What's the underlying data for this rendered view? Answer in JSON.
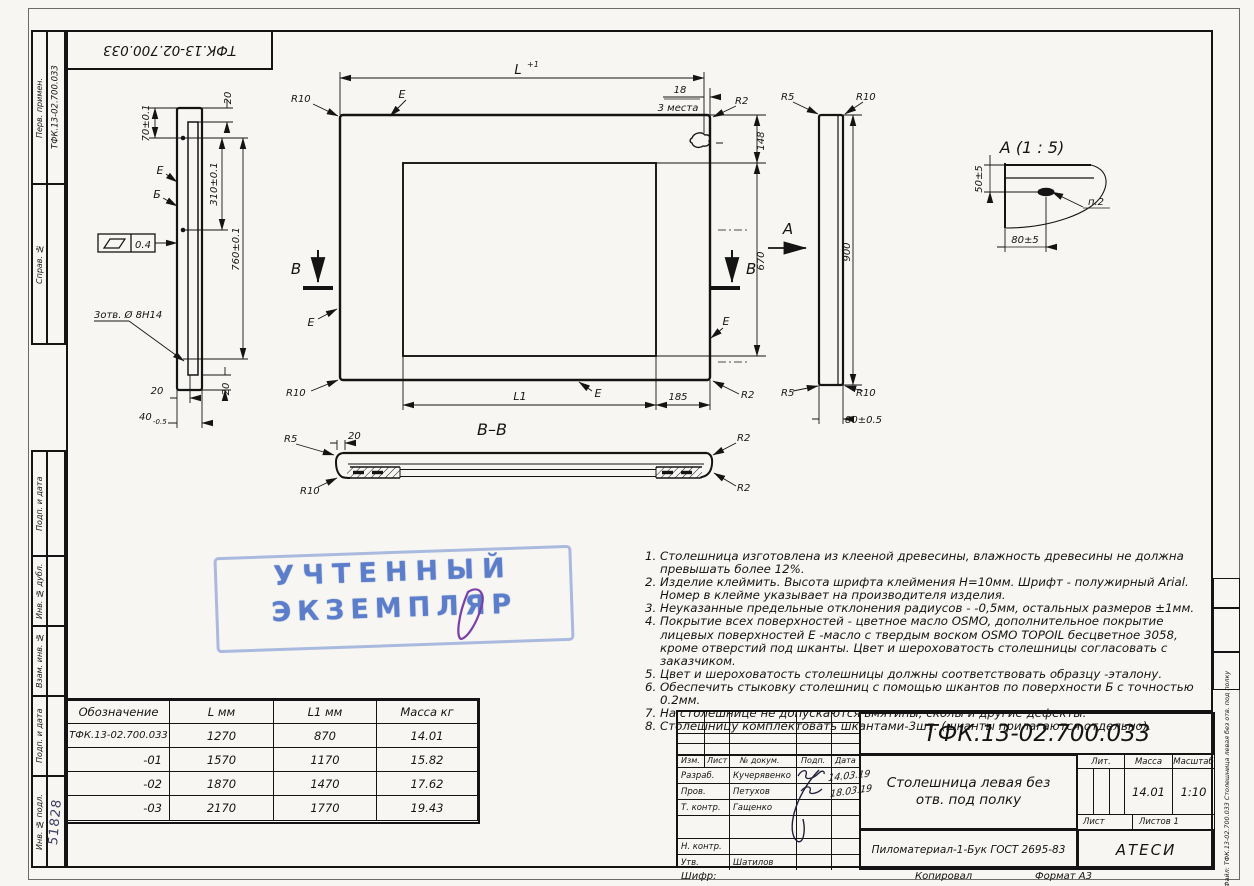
{
  "corner_stamp": {
    "doc_number": "ТФК.13-02.700.033"
  },
  "left_margin": {
    "perv_label": "Перв. примен.",
    "perv_value": "ТФК.13-02.700.033",
    "sprav_label": "Справ. №",
    "podp_data_1": "Подп. и дата",
    "inv_dubl_label": "Инв. № дубл.",
    "vzam_inv_label": "Взам. инв. №",
    "podp_data_2": "Подп. и дата",
    "inv_podl_label": "Инв. № подл.",
    "inv_podl_value": "51828"
  },
  "right_margin": {
    "file_label": "Файл: ТФК.13-02.700.033 Столешница левая без отв. под полку"
  },
  "dims": {
    "d70": "70±0.1",
    "d20": "20",
    "d310": "310±0.1",
    "d760": "760±0.1",
    "d40": "40",
    "d40_tol": "-0.5",
    "holes": "3отв. Ø 8Н14",
    "flatness": "0.4",
    "surf_e": "Е",
    "surf_b": "Б",
    "len_L": "L",
    "len_L_tol": "+1",
    "d18": "18",
    "places": "3 места",
    "r2": "R2",
    "r5": "R5",
    "r10": "R10",
    "d148": "148",
    "d670": "670",
    "len_L1": "L1",
    "d185": "185",
    "sec_letter": "В",
    "view_letter": "А",
    "d900": "900",
    "d80": "80±0.5",
    "detail_title": "А  (1 : 5)",
    "d50": "50±5",
    "d80_detail": "80±5",
    "callout_p2": "п.2",
    "section_title": "В–В"
  },
  "blue_stamp": {
    "line1": "УЧТЕННЫЙ",
    "line2": "ЭКЗЕМПЛЯР"
  },
  "notes": [
    "1. Столешница изготовлена из клееной древесины, влажность древесины не должна превышать более 12%.",
    "2. Изделие клеймить. Высота шрифта клеймения Н=10мм. Шрифт - полужирный Arial. Номер в клейме указывает на производителя изделия.",
    "3. Неуказанные предельные отклонения радиусов - -0,5мм, остальных размеров ±1мм.",
    "4. Покрытие всех поверхностей - цветное масло OSMO, дополнительное покрытие лицевых поверхностей Е -масло с твердым воском OSMO TOPOIL бесцветное 3058, кроме отверстий под шканты. Цвет и шероховатость столешницы согласовать с заказчиком.",
    "5. Цвет и шероховатость столешницы должны соответствовать образцу -эталону.",
    "6. Обеспечить стыковку столешниц с помощью шкантов по поверхности Б с точностью 0.2мм.",
    "7. На столешнице не допускаются вмятины, сколы и другие дефекты.",
    "8. Столешницу комплектовать шкантами-3шт. (шканты прилагаются отдельно)."
  ],
  "size_table": {
    "headers": [
      "Обозначение",
      "L мм",
      "L1 мм",
      "Масса кг"
    ],
    "rows": [
      [
        "ТФК.13-02.700.033",
        "1270",
        "870",
        "14.01"
      ],
      [
        "-01",
        "1570",
        "1170",
        "15.82"
      ],
      [
        "-02",
        "1870",
        "1470",
        "17.62"
      ],
      [
        "-03",
        "2170",
        "1770",
        "19.43"
      ]
    ]
  },
  "title_block": {
    "doc_number": "ТФК.13-02.700.033",
    "product_title": "Столешница левая без отв. под полку",
    "material": "Пиломатериал-1-Бук ГОСТ 2695-83",
    "company": "АТЕСИ",
    "col_izm": "Изм.",
    "col_list": "Лист",
    "col_doc": "№ докум.",
    "col_podp": "Подп.",
    "col_data": "Дата",
    "razrab_label": "Разраб.",
    "razrab_name": "Кучерявенко",
    "prov_label": "Пров.",
    "prov_name": "Петухов",
    "tkontr_label": "Т. контр.",
    "tkontr_name": "Гащенко",
    "nkontr_label": "Н. контр.",
    "utv_label": "Утв.",
    "utv_name": "Шатилов",
    "date1": "14.03.19",
    "date2": "18.03.19",
    "lit_label": "Лит.",
    "mass_label": "Масса",
    "scale_label": "Масштаб",
    "mass_value": "14.01",
    "scale_value": "1:10",
    "sheet_label": "Лист",
    "sheets_label": "Листов 1"
  },
  "footer": {
    "shifr": "Шифр:",
    "copied": "Копировал",
    "format": "Формат А3"
  }
}
